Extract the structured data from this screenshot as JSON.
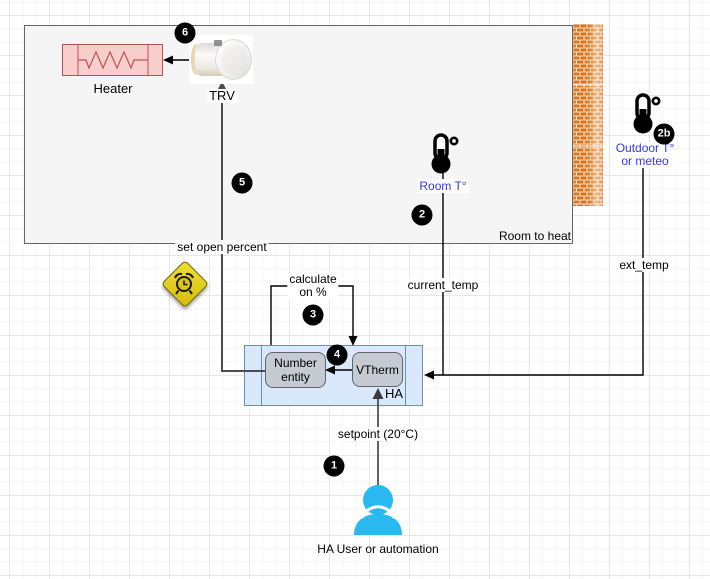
{
  "labels": {
    "heater": "Heater",
    "trv": "TRV",
    "room_to_heat": "Room to heat",
    "set_open_percent": "set open percent",
    "calculate_line1": "calculate",
    "calculate_line2": "on %",
    "current_temp": "current_temp",
    "ext_temp": "ext_temp",
    "room_temp": "Room T°",
    "outdoor_line1": "Outdoor T°",
    "outdoor_line2": "or meteo",
    "setpoint": "setpoint (20°C)",
    "user": "HA User or automation",
    "ha": "HA",
    "number_entity_line1": "Number",
    "number_entity_line2": "entity",
    "vtherm": "VTherm"
  },
  "badges": {
    "b1": "1",
    "b2": "2",
    "b2b": "2b",
    "b3": "3",
    "b4": "4",
    "b5": "5",
    "b6": "6"
  },
  "icons": {
    "trv_device": "trv-valve-photo",
    "warning": "alarm-clock-warning-icon",
    "room_sensor": "thermometer-icon",
    "outdoor_sensor": "thermometer-icon",
    "wall": "brick-wall",
    "person": "user-icon"
  },
  "colors": {
    "room_fill": "#f5f5f5",
    "heater_fill": "#f8cecc",
    "heater_stroke": "#b85450",
    "ha_box_fill": "#dae8fc",
    "ha_box_stroke": "#6c8ebf",
    "inner_node_fill": "#c5cad3",
    "sensor_label_blue": "#3535f3",
    "user_icon_blue": "#29b8ef",
    "badge_bg": "#000000",
    "brick_orange": "#e0761f",
    "warning_yellow": "#e3cd17"
  }
}
